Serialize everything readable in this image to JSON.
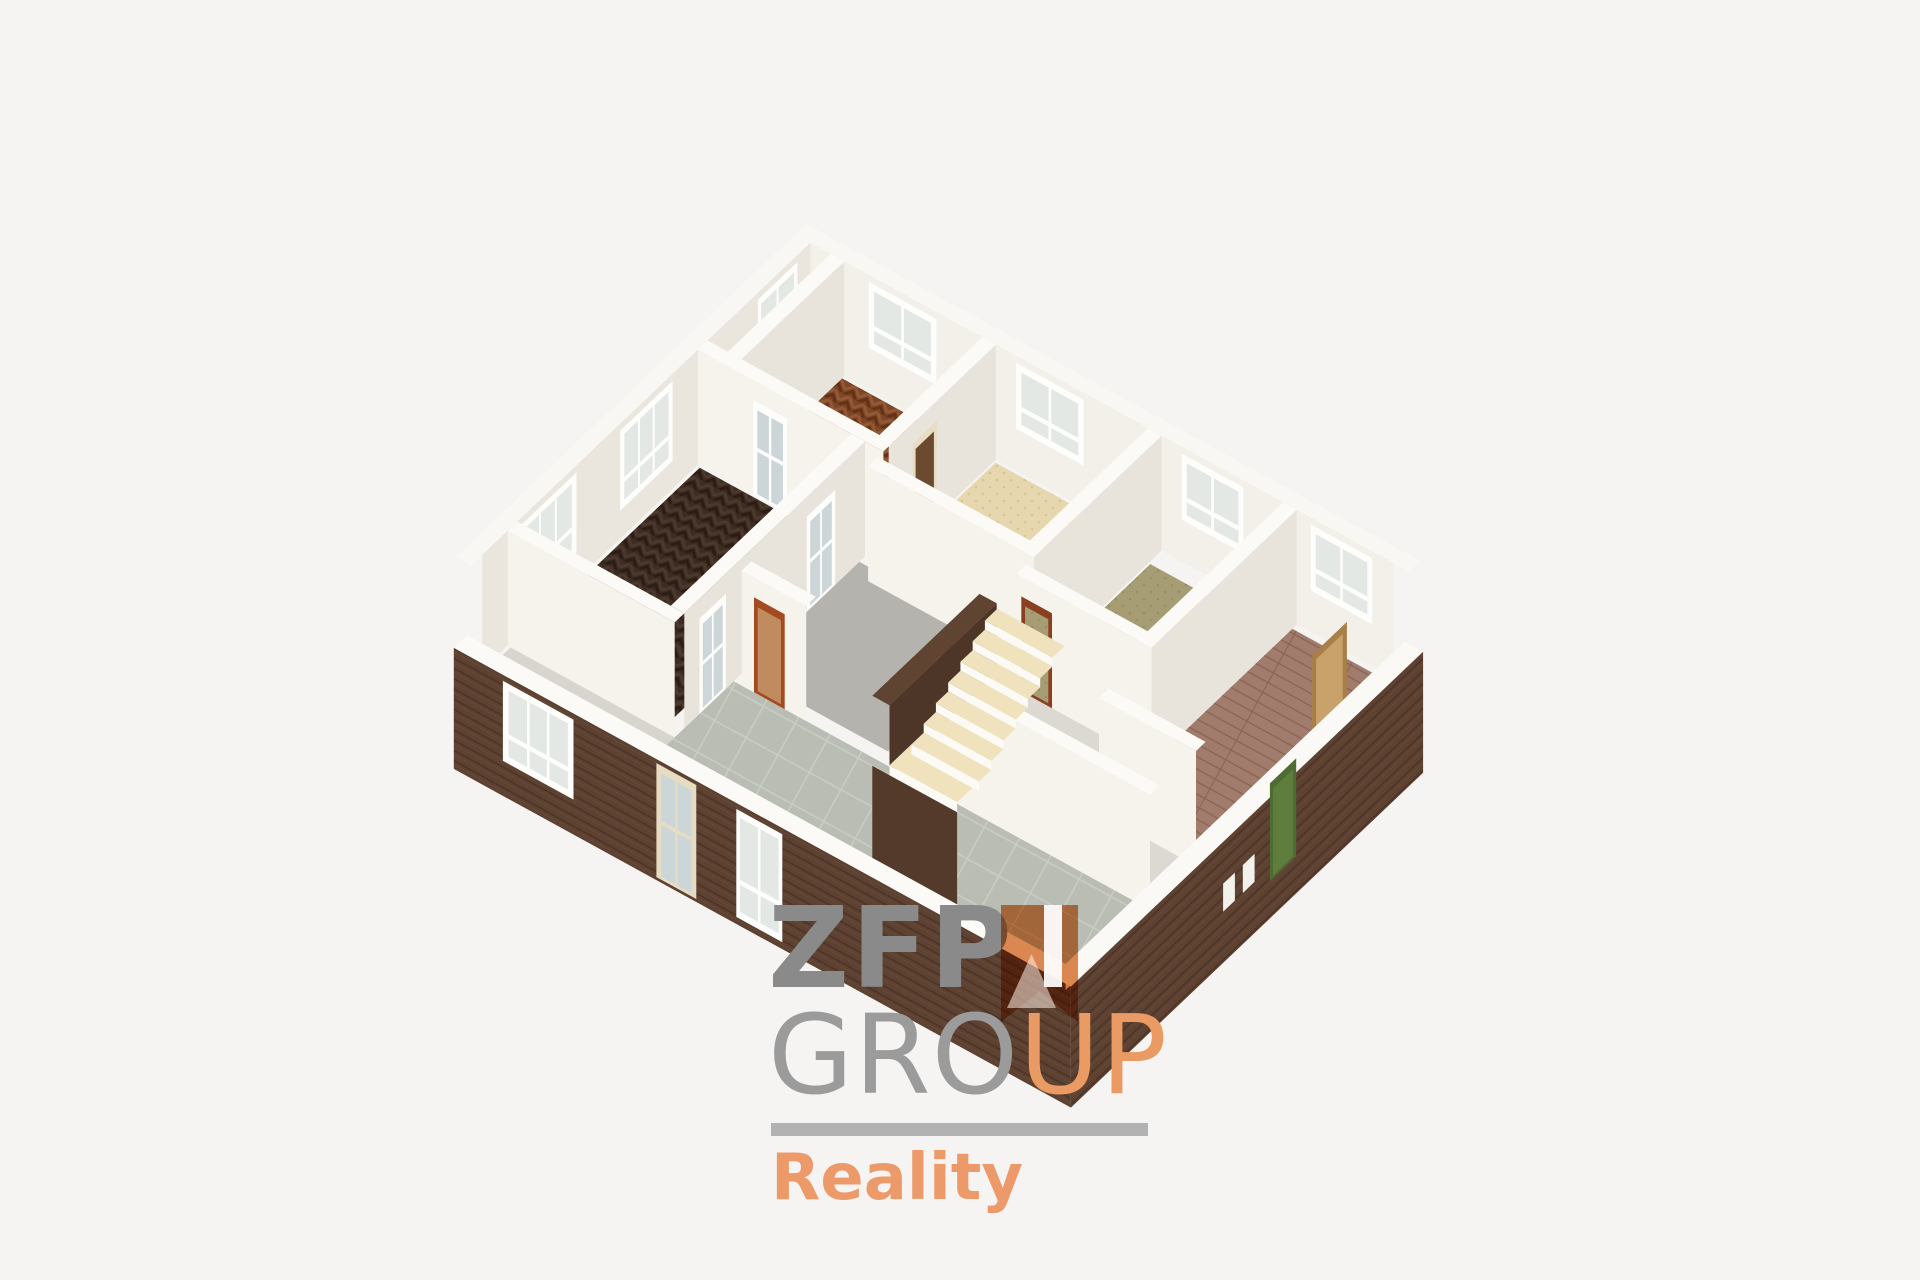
{
  "canvas": {
    "width": 1920,
    "height": 1280,
    "background": "#f5f4f2"
  },
  "logo": {
    "zfp": "ZFP",
    "group_gray": "GRO",
    "group_orange": "UP",
    "tagline": "Reality",
    "colors": {
      "zfp_gray": "#8a8a8a",
      "group_gray": "#9b9b9b",
      "orange": "#ea9a63",
      "bar_gray": "#b2b2b2",
      "reality_orange": "#ed9a6a",
      "ribbon_orange": "#dd8044"
    }
  },
  "floorplan": {
    "projection": {
      "origin": [
        806,
        339
      ],
      "u_axis": [
        61.4,
        33.7
      ],
      "v_axis": [
        -43.75,
        41.6
      ],
      "wall_height": 115,
      "base_height": 95
    },
    "palette": {
      "frame": "#fdfdfb",
      "glass": "#e4e8e4",
      "wall_bright": "#f6f3ed",
      "wall_shadow": "#e8e4dc",
      "wall_cap": "#fbfaf7"
    },
    "patterns": [
      {
        "id": "herrA",
        "kind": "chevron",
        "base": "#7d4627",
        "light": "#935834",
        "dark": "#633114",
        "angle": 28.7
      },
      {
        "id": "herrE",
        "kind": "chevron",
        "base": "#3d2c22",
        "light": "#4c392d",
        "dark": "#2b1d15",
        "angle": 28.7
      },
      {
        "id": "planks",
        "kind": "planks",
        "base": "#a17c6c",
        "line": "#8a6455",
        "angle": 28.7
      },
      {
        "id": "tiles",
        "kind": "grid",
        "base": "#b9bdb4",
        "line": "#c9ccc3",
        "angle": 28.7
      },
      {
        "id": "specBeige",
        "kind": "speckle",
        "base": "#e7d7ae",
        "dot": "#d3bc89"
      },
      {
        "id": "specOlive",
        "kind": "speckle",
        "base": "#a69d74",
        "dot": "#92895e"
      },
      {
        "id": "brickSW",
        "kind": "brick",
        "base": "#5d4131",
        "dark": "#4a3227",
        "light": "#6e4e3b",
        "angle": 28.7
      },
      {
        "id": "brickSE",
        "kind": "brick",
        "base": "#5d4131",
        "dark": "#4a3227",
        "light": "#6e4e3b",
        "angle": -43.5
      }
    ],
    "elements": [
      {
        "t": "hquad",
        "name": "ne-facade-cap",
        "rect": [
          0,
          0,
          10,
          0.25
        ],
        "e": 115,
        "fill": "#f8f7f3"
      },
      {
        "t": "hquad",
        "name": "nw-facade-cap",
        "rect": [
          0,
          0,
          0.25,
          8
        ],
        "e": 115,
        "fill": "#f8f7f3"
      },
      {
        "t": "faceU",
        "name": "nw-facade-inner-wall",
        "u": 0.25,
        "v": [
          0.25,
          7.75
        ],
        "top": 115,
        "bot": 0,
        "fill": "#eae6de"
      },
      {
        "t": "faceV",
        "name": "ne-facade-inner-wall",
        "v": 0.25,
        "u": [
          0.25,
          9.75
        ],
        "top": 115,
        "bot": 0,
        "fill": "#f3f0e9"
      },
      {
        "t": "window",
        "name": "window-nw-parquet",
        "orient": "U",
        "c": 0.25,
        "r": [
          0.55,
          1.45
        ],
        "top": 108,
        "bot": 28,
        "sashes": 2
      },
      {
        "t": "window",
        "name": "window-nw-espresso-1",
        "orient": "U",
        "c": 0.25,
        "r": [
          3.4,
          4.6
        ],
        "top": 108,
        "bot": 28,
        "sashes": 3
      },
      {
        "t": "window",
        "name": "window-nw-espresso-2",
        "orient": "U",
        "c": 0.25,
        "r": [
          5.6,
          6.9
        ],
        "top": 108,
        "bot": 28,
        "sashes": 3
      },
      {
        "t": "window",
        "name": "window-ne-parquet",
        "orient": "V",
        "c": 0.25,
        "r": [
          1.2,
          2.3
        ],
        "top": 108,
        "bot": 42,
        "sashes": 2
      },
      {
        "t": "window",
        "name": "window-ne-beige",
        "orient": "V",
        "c": 0.25,
        "r": [
          3.6,
          4.7
        ],
        "top": 108,
        "bot": 42,
        "sashes": 2
      },
      {
        "t": "window",
        "name": "window-ne-olive",
        "orient": "V",
        "c": 0.25,
        "r": [
          6.3,
          7.3
        ],
        "top": 108,
        "bot": 42,
        "sashes": 2
      },
      {
        "t": "window",
        "name": "window-ne-wood",
        "orient": "V",
        "c": 0.25,
        "r": [
          8.4,
          9.4
        ],
        "top": 108,
        "bot": 42,
        "sashes": 2
      },
      {
        "t": "floor",
        "name": "closet-floor",
        "rect": [
          0.25,
          0.3,
          0.8,
          2.6
        ],
        "fill": "#efece6"
      },
      {
        "t": "floor",
        "name": "parquet-room-floor",
        "rect": [
          0.8,
          0.3,
          3.05,
          2.6
        ],
        "fill": "p:herrA"
      },
      {
        "t": "floor",
        "name": "beige-room-floor",
        "rect": [
          3.3,
          0.3,
          5.75,
          2.95
        ],
        "fill": "p:specBeige"
      },
      {
        "t": "floor",
        "name": "olive-room-floor",
        "rect": [
          6.0,
          0.55,
          7.95,
          3.35
        ],
        "fill": "p:specOlive"
      },
      {
        "t": "floor",
        "name": "hallway-floor",
        "rect": [
          4.97,
          3.17,
          9.75,
          5.6
        ],
        "fill": "#dcd9d2"
      },
      {
        "t": "floor",
        "name": "wood-room-floor",
        "rect": [
          8.05,
          0.35,
          9.7,
          4.55
        ],
        "fill": "p:planks"
      },
      {
        "t": "floor",
        "name": "espresso-room-floor",
        "rect": [
          0.3,
          2.85,
          2.75,
          6.95
        ],
        "fill": "p:herrE"
      },
      {
        "t": "floor",
        "name": "stair-hall-floor",
        "rect": [
          2.97,
          2.95,
          5.32,
          5.6
        ],
        "fill": "#b5b3ae"
      },
      {
        "t": "floor",
        "name": "entry-floor",
        "rect": [
          0.3,
          7.17,
          2.97,
          7.7
        ],
        "fill": "#d8d5ce"
      },
      {
        "t": "floor",
        "name": "tile-room-floor",
        "rect": [
          2.97,
          5.82,
          9.75,
          7.7
        ],
        "fill": "p:tiles"
      },
      {
        "t": "faceU",
        "name": "closet-wall-face",
        "u": 0.8,
        "v": [
          0.25,
          2.6
        ],
        "top": 115,
        "bot": 0,
        "fill": "#e8e4dc"
      },
      {
        "t": "hquad",
        "name": "closet-wall-cap",
        "rect": [
          0.58,
          0.25,
          0.8,
          2.6
        ],
        "e": 115,
        "fill": "#fbfaf7"
      },
      {
        "t": "faceU",
        "name": "wall-parquet-beige-face",
        "u": 3.27,
        "v": [
          0.25,
          2.7
        ],
        "top": 115,
        "bot": 0,
        "fill": "#e8e4dc"
      },
      {
        "t": "hquad",
        "name": "wall-parquet-beige-cap",
        "rect": [
          3.05,
          0.25,
          3.27,
          2.7
        ],
        "e": 115,
        "fill": "#fbfaf7"
      },
      {
        "t": "door",
        "name": "door-parquet-beige",
        "orient": "U",
        "c": 3.27,
        "r": [
          1.6,
          2.15
        ],
        "top": 95,
        "bot": 0,
        "frame": "#e8ddc4",
        "panel": "#6b4a30"
      },
      {
        "t": "faceU",
        "name": "wall-beige-olive-face",
        "u": 5.97,
        "v": [
          0.25,
          3.35
        ],
        "top": 115,
        "bot": 0,
        "fill": "#e8e4dc"
      },
      {
        "t": "hquad",
        "name": "wall-beige-olive-cap",
        "rect": [
          5.75,
          0.25,
          5.97,
          3.35
        ],
        "e": 115,
        "fill": "#fbfaf7"
      },
      {
        "t": "faceU",
        "name": "wall-olive-wood-face",
        "u": 8.17,
        "v": [
          0.25,
          4.55
        ],
        "top": 115,
        "bot": 0,
        "fill": "#e8e4dc"
      },
      {
        "t": "hquad",
        "name": "wall-olive-wood-cap",
        "rect": [
          7.95,
          0.25,
          8.17,
          4.55
        ],
        "e": 115,
        "fill": "#fbfaf7"
      },
      {
        "t": "faceV",
        "name": "wall-parquet-south-face",
        "v": 2.82,
        "u": [
          0.25,
          3.27
        ],
        "top": 115,
        "bot": 0,
        "fill": "#f6f3ed"
      },
      {
        "t": "hquad",
        "name": "wall-parquet-south-cap",
        "rect": [
          0.25,
          2.6,
          3.27,
          2.82
        ],
        "e": 115,
        "fill": "#fbfaf7"
      },
      {
        "t": "door",
        "name": "door-glazed-parquet",
        "orient": "V",
        "c": 2.82,
        "r": [
          1.15,
          1.7
        ],
        "top": 95,
        "bot": 0,
        "frame": "#fdfdfb",
        "panel": "#ccd6d8",
        "bars": true
      },
      {
        "t": "faceV",
        "name": "wall-beige-south-face",
        "v": 3.17,
        "u": [
          3.27,
          5.97
        ],
        "top": 115,
        "bot": 0,
        "fill": "#f6f3ed"
      },
      {
        "t": "hquad",
        "name": "wall-beige-south-cap",
        "rect": [
          3.27,
          2.95,
          5.97,
          3.17
        ],
        "e": 115,
        "fill": "#fbfaf7"
      },
      {
        "t": "faceV",
        "name": "wall-olive-south-face",
        "v": 3.57,
        "u": [
          5.97,
          8.17
        ],
        "top": 115,
        "bot": 0,
        "fill": "#f6f3ed"
      },
      {
        "t": "hquad",
        "name": "wall-olive-south-cap",
        "rect": [
          5.97,
          3.35,
          8.17,
          3.57
        ],
        "e": 115,
        "fill": "#fbfaf7"
      },
      {
        "t": "door",
        "name": "door-hall-olive",
        "orient": "V",
        "c": 3.57,
        "r": [
          6.05,
          6.55
        ],
        "top": 95,
        "bot": 0,
        "frame": "#8a4020",
        "panel": "p:specOlive"
      },
      {
        "t": "faceU",
        "name": "wall-espresso-east-face",
        "u": 2.97,
        "v": [
          2.82,
          6.95
        ],
        "top": 115,
        "bot": 0,
        "fill": "#e8e4dc"
      },
      {
        "t": "hquad",
        "name": "wall-espresso-east-cap",
        "rect": [
          2.75,
          2.82,
          2.97,
          6.95
        ],
        "e": 115,
        "fill": "#fbfaf7"
      },
      {
        "t": "door",
        "name": "door-glazed-espresso-1",
        "orient": "U",
        "c": 2.97,
        "r": [
          3.5,
          4.15
        ],
        "top": 95,
        "bot": 0,
        "frame": "#fdfdfb",
        "panel": "#ccd6d8",
        "bars": true
      },
      {
        "t": "door",
        "name": "door-glazed-espresso-2",
        "orient": "U",
        "c": 2.97,
        "r": [
          6.0,
          6.6
        ],
        "top": 95,
        "bot": 0,
        "frame": "#fdfdfb",
        "panel": "#ccd6d8",
        "bars": true
      },
      {
        "t": "faceV",
        "name": "wall-wood-south-face",
        "v": 4.77,
        "u": [
          8.17,
          9.75
        ],
        "top": 115,
        "bot": 0,
        "fill": "#f6f3ed"
      },
      {
        "t": "hquad",
        "name": "wall-wood-south-cap",
        "rect": [
          8.17,
          4.55,
          9.75,
          4.77
        ],
        "e": 115,
        "fill": "#fbfaf7"
      },
      {
        "t": "faceV",
        "name": "wall-tile-north-left-face",
        "v": 5.82,
        "u": [
          3.1,
          4.15
        ],
        "top": 115,
        "bot": 0,
        "fill": "#f6f3ed"
      },
      {
        "t": "hquad",
        "name": "wall-tile-north-left-cap",
        "rect": [
          3.1,
          5.6,
          4.15,
          5.82
        ],
        "e": 115,
        "fill": "#fbfaf7"
      },
      {
        "t": "door",
        "name": "door-tile-hall",
        "orient": "V",
        "c": 5.82,
        "r": [
          3.3,
          3.8
        ],
        "top": 95,
        "bot": 0,
        "frame": "#a34a20",
        "panel": "#c08b5e"
      },
      {
        "t": "faceV",
        "name": "wall-tile-north-right-face",
        "v": 5.82,
        "u": [
          6.7,
          9.75
        ],
        "top": 115,
        "bot": 0,
        "fill": "#f6f3ed"
      },
      {
        "t": "hquad",
        "name": "wall-tile-north-right-cap",
        "rect": [
          6.7,
          5.6,
          9.75,
          5.82
        ],
        "e": 115,
        "fill": "#fbfaf7"
      },
      {
        "t": "faceV",
        "name": "wall-espresso-south-face",
        "v": 7.17,
        "u": [
          0.25,
          2.97
        ],
        "top": 115,
        "bot": 0,
        "fill": "#f6f3ed"
      },
      {
        "t": "hquad",
        "name": "wall-espresso-south-cap",
        "rect": [
          0.25,
          6.95,
          2.97,
          7.17
        ],
        "e": 115,
        "fill": "#fbfaf7"
      },
      {
        "t": "hquad",
        "name": "stairwell-wall-cap",
        "rect": [
          5.32,
          3.5,
          5.6,
          5.95
        ],
        "e": 70,
        "fill": "#5e4431"
      },
      {
        "t": "faceU",
        "name": "stairwell-wall-side",
        "u": 5.6,
        "v": [
          3.5,
          5.95
        ],
        "top": 70,
        "bot": 0,
        "fill": "#4d3527"
      },
      {
        "t": "hquad",
        "name": "stair-landing",
        "rect": [
          5.6,
          5.45,
          6.7,
          5.95
        ],
        "e": 10,
        "fill": "#f0e2bd"
      },
      {
        "t": "stairs",
        "name": "staircase",
        "u": [
          5.6,
          6.7
        ],
        "vStart": 5.45,
        "steps": 7,
        "dv": 0.28,
        "rise": 9,
        "e0": 10,
        "tread": "#f0e2bd",
        "riser": "#fcfaf4"
      },
      {
        "t": "faceV",
        "name": "stair-landing-riser",
        "v": 5.95,
        "u": [
          5.6,
          6.7
        ],
        "top": 10,
        "bot": 0,
        "fill": "#fcfaf4"
      },
      {
        "t": "faceV",
        "name": "stairwell-front",
        "v": 5.95,
        "u": [
          5.32,
          6.7
        ],
        "top": 0,
        "bot": -125,
        "fill": "#543a2a"
      },
      {
        "t": "door",
        "name": "door-wood-room",
        "orient": "U",
        "c": 9.7,
        "r": [
          1.25,
          2.05
        ],
        "top": 96,
        "bot": 0,
        "frame": "#a87f49",
        "panel": "#c9a26b"
      },
      {
        "t": "faceV",
        "name": "sw-wall-inner-cut",
        "v": 7.75,
        "u": [
          0.25,
          9.75
        ],
        "top": 26,
        "bot": 0,
        "fill": "#f1eee7"
      },
      {
        "t": "hquad",
        "name": "sw-wall-cap",
        "rect": [
          0,
          7.75,
          10.05,
          8.05
        ],
        "e": 26,
        "fill": "#fbfaf7"
      },
      {
        "t": "faceV",
        "name": "sw-wall-exterior",
        "v": 8.05,
        "u": [
          0,
          10.05
        ],
        "top": 26,
        "bot": -95,
        "fill": "p:brickSW"
      },
      {
        "t": "window",
        "name": "window-sw-espresso",
        "orient": "V",
        "c": 8.05,
        "r": [
          0.8,
          1.95
        ],
        "top": 20,
        "bot": -60,
        "sashes": 3
      },
      {
        "t": "door",
        "name": "front-door",
        "orient": "V",
        "c": 8.05,
        "r": [
          3.3,
          3.95
        ],
        "top": 22,
        "bot": -92,
        "frame": "#e6dcc2",
        "panel": "#ccd6d8",
        "bars": true
      },
      {
        "t": "window",
        "name": "window-sw-tile",
        "orient": "V",
        "c": 8.05,
        "r": [
          4.6,
          5.35
        ],
        "top": 20,
        "bot": -88,
        "sashes": 2
      },
      {
        "t": "faceU",
        "name": "se-wall-inner-cut",
        "u": 9.75,
        "v": [
          0.25,
          7.75
        ],
        "top": 26,
        "bot": 0,
        "fill": "#ece8e1"
      },
      {
        "t": "hquad",
        "name": "se-wall-cap",
        "rect": [
          9.75,
          0,
          10.05,
          8.05
        ],
        "e": 26,
        "fill": "#faf9f5"
      },
      {
        "t": "faceU",
        "name": "se-wall-exterior",
        "u": 10.05,
        "v": [
          0,
          8.05
        ],
        "top": 26,
        "bot": -95,
        "fill": "p:brickSE"
      },
      {
        "t": "door",
        "name": "green-door",
        "orient": "U",
        "c": 10.05,
        "r": [
          2.9,
          3.5
        ],
        "top": 40,
        "bot": -58,
        "frame": "#4e6c33",
        "panel": "#5f7d3c"
      },
      {
        "t": "faceU",
        "name": "se-basement-window-1",
        "u": 10.05,
        "v": [
          3.85,
          4.12
        ],
        "top": -16,
        "bot": -44,
        "fill": "#f2f1ec"
      },
      {
        "t": "faceU",
        "name": "se-basement-window-2",
        "u": 10.05,
        "v": [
          4.3,
          4.57
        ],
        "top": -16,
        "bot": -44,
        "fill": "#f2f1ec"
      }
    ]
  }
}
